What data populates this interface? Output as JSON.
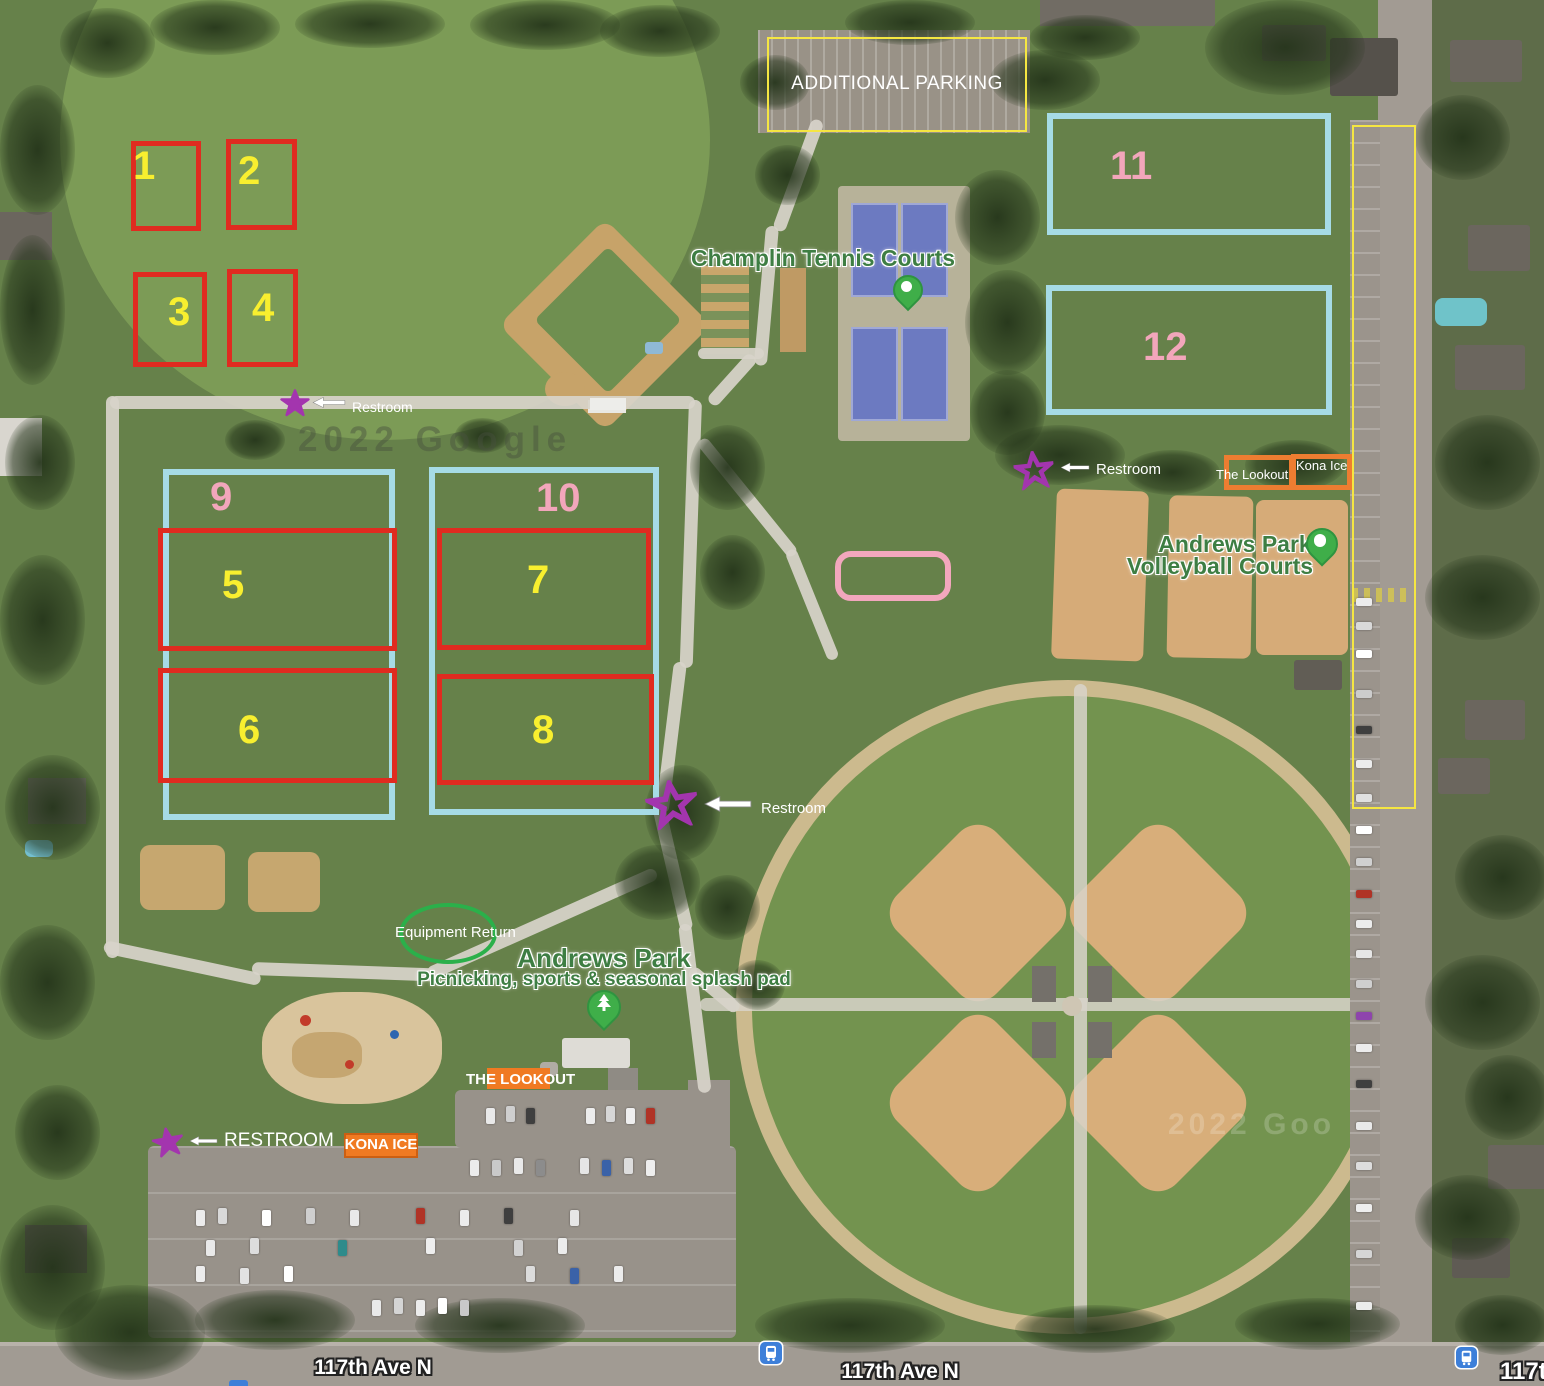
{
  "annotations": {
    "additional_parking_label": "ADDITIONAL PARKING",
    "fields": {
      "f1": "1",
      "f2": "2",
      "f3": "3",
      "f4": "4",
      "f5": "5",
      "f6": "6",
      "f7": "7",
      "f8": "8",
      "f9": "9",
      "f10": "10",
      "f11": "11",
      "f12": "12"
    },
    "restrooms": [
      {
        "label": "Restroom"
      },
      {
        "label": "Restroom"
      },
      {
        "label": "Restroom"
      },
      {
        "label": "RESTROOM"
      }
    ],
    "vendors": {
      "lookout_top": "The Lookout",
      "kona_top": "Kona Ice",
      "lookout_bottom": "THE LOOKOUT",
      "kona_bottom": "KONA ICE"
    },
    "equipment_return_label": "Equipment Return",
    "colors": {
      "field_box_red": "#e02b20",
      "field_box_blue": "#a6dbe6",
      "number_yellow": "#f8ef2f",
      "number_pink": "#f2a6bb",
      "parking_outline_yellow": "#f5e642",
      "star_purple": "#a335ae",
      "vendor_orange": "#ed7d31",
      "misc_pink": "#f2a7bd",
      "equipment_green": "#2bb04a"
    }
  },
  "map_pois": {
    "tennis_courts": "Champlin Tennis Courts",
    "volleyball_line1": "Andrews Park",
    "volleyball_line2": "Volleyball Courts",
    "park_title": "Andrews Park",
    "park_subtitle": "Picnicking, sports & seasonal splash pad"
  },
  "streets": {
    "ave_left": "117th Ave N",
    "ave_center": "117th Ave N",
    "ave_right_partial": "117th"
  },
  "watermarks": {
    "google_1": "2022 Google",
    "google_2": "2022 Goo"
  }
}
